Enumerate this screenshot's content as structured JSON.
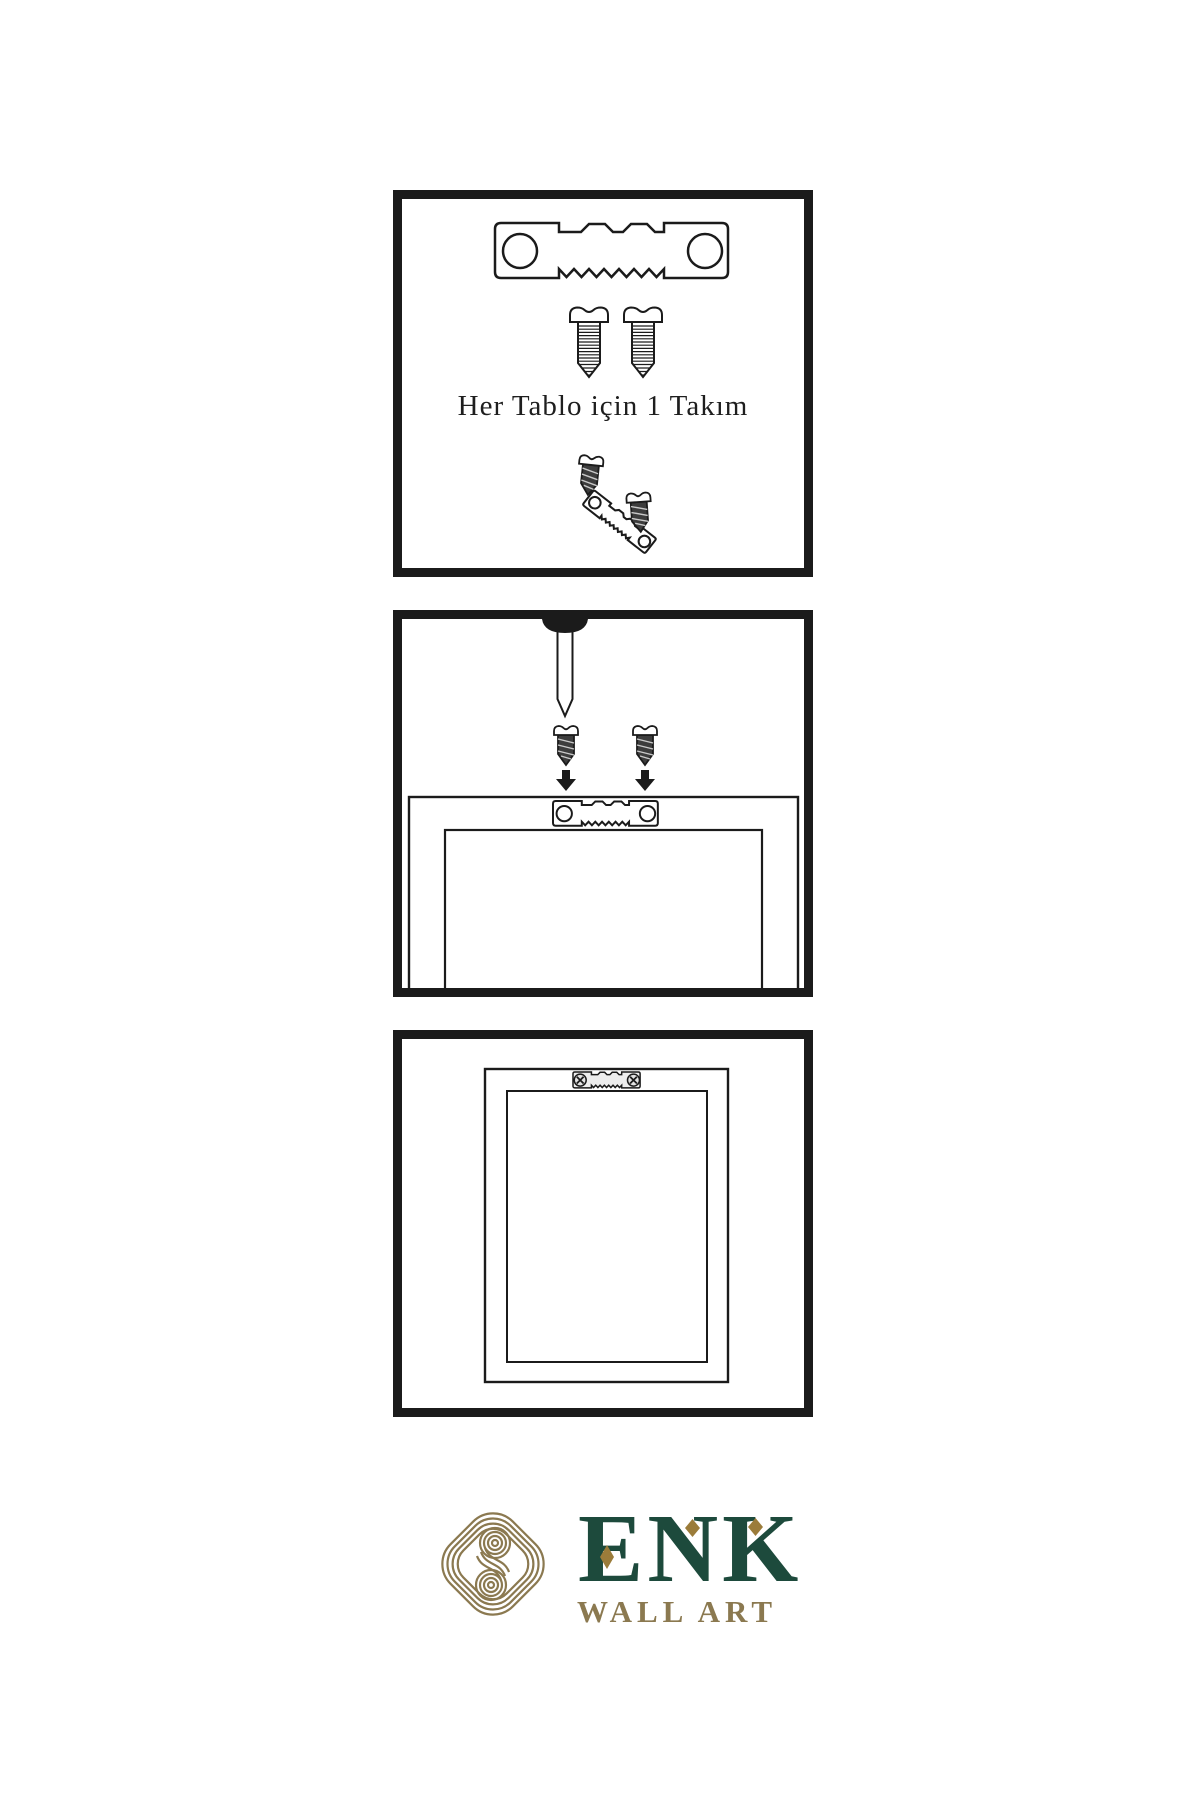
{
  "document": {
    "type": "wall-art-hanging-instructions",
    "background": "#ffffff",
    "ink": "#1b1b1b"
  },
  "panels": [
    {
      "name": "hardware-kit",
      "caption": "Her Tablo için 1 Takım",
      "contents": [
        "sawtooth-hanger",
        "screw",
        "screw",
        "screw-small",
        "sawtooth-hanger-angled",
        "screw-small"
      ]
    },
    {
      "name": "attach-hanger-to-frame-back",
      "contents": [
        "wall-nail",
        "screw-dark",
        "screw-dark",
        "arrow-down",
        "arrow-down",
        "sawtooth-hanger",
        "frame-back"
      ]
    },
    {
      "name": "frame-mounted-on-wall",
      "contents": [
        "frame-back",
        "sawtooth-hanger-screwed"
      ]
    }
  ],
  "logo": {
    "title": "ENK",
    "subtitle": "WALL ART",
    "green": "#1d4a3c",
    "gold": "#8b7950",
    "gold_dark": "#9b7c3a"
  }
}
